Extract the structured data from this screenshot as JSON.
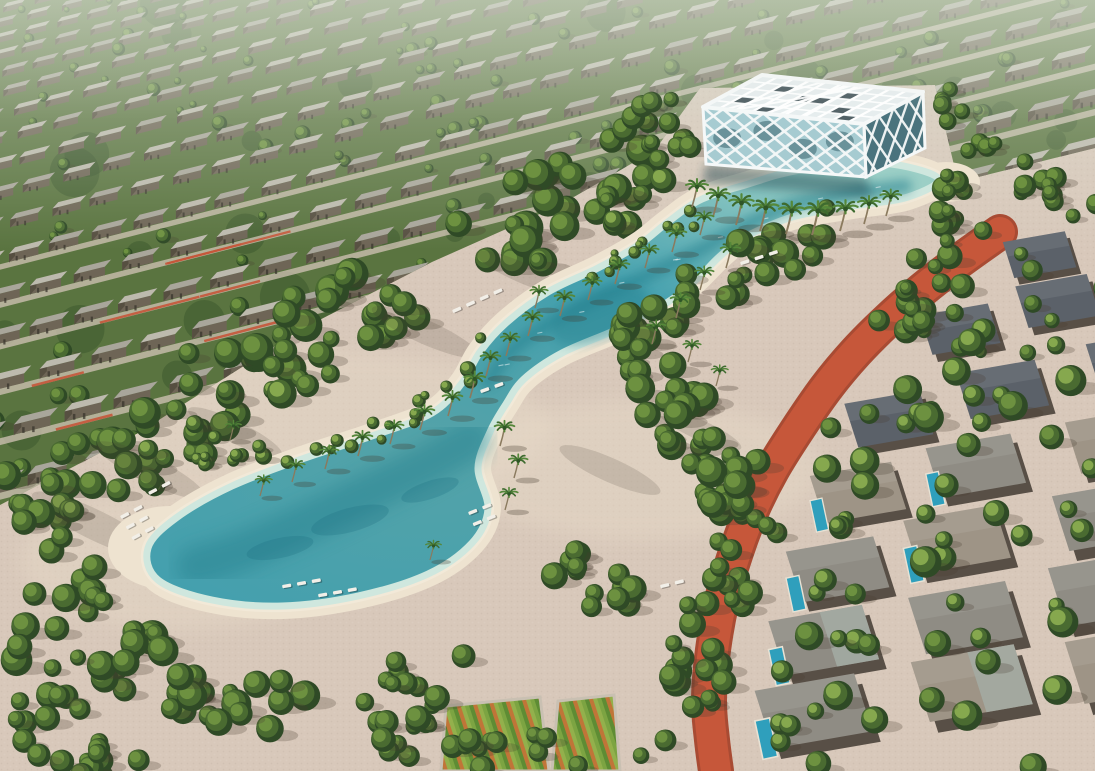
{
  "image": {
    "kind": "3d-aerial-render",
    "description": "Aerial render of a master-planned residential community: diagonal rows of grey-roofed townhouses among dense trees across the top, a white diagonal-lattice glass pavilion standing in a turquoise lagoon, a winding sandy-edged swim lagoon dotted with palm trees and white sun loungers, a terracotta jogging track curving along a district of flat-roofed pool villas on the right, and community garden plots with tree-lined cobbled plazas at the bottom.",
    "width": 1095,
    "height": 771
  },
  "palette": {
    "paving": "#d8c8ba",
    "pavingLight": "#e7dac8",
    "pavingWarm": "#dcc9b8",
    "sand": "#eee3d0",
    "sandBright": "#f4ebdb",
    "waterShallow": "#cfe7de",
    "waterLight": "#9ccfc6",
    "waterMid": "#55a3a8",
    "waterDeep": "#27818f",
    "waterChannel": "#44a0ae",
    "treeDark": "#2f4a26",
    "treeMid": "#4a6b31",
    "treeLight": "#6d9140",
    "treeBright": "#86a84e",
    "shrub": "#9ab04f",
    "roofLight": "#a9a69b",
    "roofPale": "#bdbaae",
    "wallDark": "#564f41",
    "wallMid": "#6e6556",
    "track": "#c6573a",
    "trackEdge": "#a84b33",
    "villaRoofA": "#8f8c84",
    "villaRoofB": "#9e9486",
    "villaRoofDark": "#5b6169",
    "villaWall": "#584f46",
    "villaPanel": "#a3aca3",
    "pool": "#2f9fbc",
    "pavilionFrame": "#f5f8f8",
    "pavilionGlass": "#a6cbd1",
    "pavilionGlassDark": "#4a737d",
    "skylight": "#36464c",
    "shadow": "#473d30",
    "trunk": "#8a7a5e",
    "gardenA": "#7ca442",
    "gardenB": "#5e8c34",
    "gardenC": "#c07538",
    "gardenD": "#93b04c",
    "haze": "#dfe5d8",
    "grassBase": "#5a7440",
    "streetPale": "#d3c5b7"
  },
  "areas": [
    {
      "name": "townhouse-district",
      "label": "Townhouse rows with street trees"
    },
    {
      "name": "lattice-pavilion",
      "label": "White lattice clubhouse pavilion on the lagoon"
    },
    {
      "name": "swim-lagoon",
      "label": "Winding turquoise swim lagoon"
    },
    {
      "name": "beach",
      "label": "Sandy lagoon beaches"
    },
    {
      "name": "palm-grove",
      "label": "Palm trees along the lagoon"
    },
    {
      "name": "sun-loungers",
      "label": "White sun loungers on the beach"
    },
    {
      "name": "jogging-track",
      "label": "Terracotta jogging track"
    },
    {
      "name": "villa-district",
      "label": "Flat-roof villas with private pools"
    },
    {
      "name": "community-gardens",
      "label": "Community garden allotments"
    },
    {
      "name": "plaza",
      "label": "Cobbled plaza with tree clusters"
    }
  ],
  "geometry": {
    "canvas": [
      1095,
      771
    ],
    "housing": {
      "clip": [
        [
          0,
          0
        ],
        [
          1095,
          0
        ],
        [
          1095,
          148
        ],
        [
          958,
          182
        ],
        [
          935,
          85
        ],
        [
          700,
          88
        ],
        [
          655,
          150
        ],
        [
          560,
          205
        ],
        [
          432,
          262
        ],
        [
          300,
          330
        ],
        [
          140,
          432
        ],
        [
          0,
          505
        ]
      ],
      "slope": 0.26,
      "rowStartY": 8,
      "rowMaxY": 520
    },
    "forest": {
      "path": [
        [
          0,
          505
        ],
        [
          140,
          435
        ],
        [
          300,
          332
        ],
        [
          432,
          265
        ],
        [
          560,
          208
        ],
        [
          650,
          152
        ]
      ],
      "width": 85,
      "count": 78
    },
    "lagoonOutline": [
      [
        938,
        178
      ],
      [
        880,
        163
      ],
      [
        800,
        170
      ],
      [
        745,
        185
      ],
      [
        700,
        200
      ],
      [
        668,
        222
      ],
      [
        640,
        244
      ],
      [
        598,
        268
      ],
      [
        548,
        292
      ],
      [
        506,
        323
      ],
      [
        480,
        352
      ],
      [
        462,
        383
      ],
      [
        432,
        413
      ],
      [
        372,
        436
      ],
      [
        302,
        459
      ],
      [
        232,
        486
      ],
      [
        176,
        518
      ],
      [
        148,
        548
      ],
      [
        158,
        580
      ],
      [
        212,
        600
      ],
      [
        282,
        606
      ],
      [
        358,
        596
      ],
      [
        428,
        574
      ],
      [
        472,
        543
      ],
      [
        488,
        509
      ],
      [
        478,
        468
      ],
      [
        490,
        432
      ],
      [
        506,
        404
      ],
      [
        524,
        379
      ],
      [
        562,
        353
      ],
      [
        620,
        328
      ],
      [
        668,
        302
      ],
      [
        696,
        280
      ],
      [
        718,
        258
      ],
      [
        740,
        240
      ],
      [
        768,
        226
      ],
      [
        800,
        215
      ],
      [
        852,
        206
      ],
      [
        908,
        197
      ]
    ],
    "channelCenter": [
      [
        905,
        186
      ],
      [
        848,
        194
      ],
      [
        792,
        205
      ],
      [
        744,
        226
      ],
      [
        700,
        250
      ],
      [
        650,
        274
      ],
      [
        600,
        298
      ],
      [
        552,
        322
      ],
      [
        512,
        350
      ],
      [
        488,
        382
      ]
    ],
    "teardropCenter": [
      [
        470,
        440
      ],
      [
        424,
        466
      ],
      [
        362,
        496
      ],
      [
        300,
        526
      ],
      [
        240,
        552
      ],
      [
        196,
        566
      ]
    ],
    "midPoolEllipse": [
      600,
      315,
      52,
      24,
      -23
    ],
    "track": {
      "path": [
        [
          1000,
          232
        ],
        [
          958,
          262
        ],
        [
          922,
          290
        ],
        [
          888,
          320
        ],
        [
          856,
          352
        ],
        [
          826,
          388
        ],
        [
          797,
          430
        ],
        [
          772,
          470
        ],
        [
          752,
          510
        ],
        [
          736,
          552
        ],
        [
          722,
          600
        ],
        [
          713,
          650
        ],
        [
          709,
          700
        ],
        [
          712,
          740
        ],
        [
          716,
          771
        ]
      ],
      "width": 30
    },
    "bands": [
      {
        "path": [
          [
            608,
            348
          ],
          [
            666,
            312
          ],
          [
            728,
            276
          ],
          [
            790,
            246
          ],
          [
            846,
            226
          ]
        ],
        "width": 55,
        "count": 32,
        "r": [
          8,
          15
        ]
      },
      {
        "path": [
          [
            612,
            352
          ],
          [
            668,
            402
          ],
          [
            718,
            458
          ],
          [
            752,
            516
          ]
        ],
        "width": 65,
        "count": 34,
        "r": [
          9,
          16
        ]
      },
      {
        "path": [
          [
            768,
            480
          ],
          [
            736,
            556
          ],
          [
            706,
            642
          ],
          [
            678,
            724
          ],
          [
            664,
            771
          ]
        ],
        "width": 60,
        "count": 32,
        "r": [
          8,
          15
        ]
      },
      {
        "path": [
          [
            0,
            622
          ],
          [
            96,
            652
          ],
          [
            200,
            682
          ],
          [
            310,
            700
          ]
        ],
        "width": 75,
        "count": 40,
        "r": [
          8,
          16
        ]
      },
      {
        "path": [
          [
            360,
            716
          ],
          [
            440,
            736
          ],
          [
            520,
            758
          ],
          [
            580,
            771
          ]
        ],
        "width": 55,
        "count": 24,
        "r": [
          7,
          13
        ]
      },
      {
        "path": [
          [
            940,
            180
          ],
          [
            966,
            214
          ],
          [
            952,
            258
          ],
          [
            920,
            295
          ],
          [
            888,
            330
          ]
        ],
        "width": 55,
        "count": 28,
        "r": [
          7,
          13
        ]
      },
      {
        "path": [
          [
            648,
            100
          ],
          [
            662,
            128
          ],
          [
            680,
            155
          ]
        ],
        "width": 42,
        "count": 12,
        "r": [
          7,
          12
        ]
      },
      {
        "path": [
          [
            196,
            452
          ],
          [
            240,
            448
          ],
          [
            266,
            458
          ]
        ],
        "width": 28,
        "count": 10,
        "r": [
          5,
          9
        ],
        "bright": true
      },
      {
        "path": [
          [
            560,
            560
          ],
          [
            600,
            586
          ],
          [
            636,
            614
          ]
        ],
        "width": 48,
        "count": 16,
        "r": [
          8,
          14
        ]
      },
      {
        "path": [
          [
            30,
            498
          ],
          [
            66,
            556
          ],
          [
            94,
            612
          ]
        ],
        "width": 44,
        "count": 12,
        "r": [
          8,
          15
        ]
      },
      {
        "path": [
          [
            506,
            323
          ],
          [
            462,
            383
          ],
          [
            372,
            436
          ],
          [
            302,
            459
          ],
          [
            232,
            486
          ]
        ],
        "width": 24,
        "count": 18,
        "r": [
          4,
          8
        ],
        "bright": true,
        "noShadow": true
      },
      {
        "path": [
          [
            700,
            215
          ],
          [
            652,
            243
          ],
          [
            598,
            268
          ],
          [
            548,
            292
          ]
        ],
        "width": 18,
        "count": 12,
        "r": [
          4,
          7
        ],
        "bright": true,
        "noShadow": true
      },
      {
        "path": [
          [
            928,
            95
          ],
          [
            962,
            125
          ],
          [
            996,
            150
          ]
        ],
        "width": 38,
        "count": 10,
        "r": [
          7,
          11
        ]
      },
      {
        "path": [
          [
            1005,
            170
          ],
          [
            1050,
            195
          ],
          [
            1088,
            225
          ]
        ],
        "width": 44,
        "count": 12,
        "r": [
          7,
          12
        ]
      },
      {
        "path": [
          [
            0,
            700
          ],
          [
            60,
            730
          ],
          [
            140,
            760
          ]
        ],
        "width": 70,
        "count": 20,
        "r": [
          8,
          15
        ]
      },
      {
        "path": [
          [
            356,
            700
          ],
          [
            420,
            660
          ],
          [
            470,
            690
          ]
        ],
        "width": 60,
        "count": 8,
        "r": [
          8,
          13
        ]
      }
    ],
    "streaks": [
      [
        150,
        470,
        60,
        13,
        26
      ],
      [
        95,
        525,
        70,
        15,
        26
      ],
      [
        235,
        432,
        52,
        11,
        26
      ],
      [
        425,
        332,
        58,
        12,
        24
      ],
      [
        520,
        272,
        48,
        10,
        24
      ],
      [
        610,
        470,
        55,
        12,
        24
      ],
      [
        700,
        430,
        45,
        10,
        24
      ]
    ],
    "toneSpots": [
      [
        320,
        430,
        230,
        80
      ],
      [
        640,
        470,
        180,
        70
      ],
      [
        180,
        560,
        160,
        70
      ]
    ],
    "gardens": [
      [
        [
          446,
          706
        ],
        [
          540,
          697
        ],
        [
          549,
          771
        ],
        [
          441,
          771
        ]
      ],
      [
        [
          558,
          701
        ],
        [
          614,
          695
        ],
        [
          620,
          771
        ],
        [
          552,
          771
        ]
      ]
    ],
    "palms": [
      [
        692,
        207,
        1.0
      ],
      [
        713,
        217,
        1.05
      ],
      [
        736,
        225,
        1.1
      ],
      [
        760,
        231,
        1.15
      ],
      [
        786,
        234,
        1.15
      ],
      [
        812,
        235,
        1.2
      ],
      [
        840,
        231,
        1.1
      ],
      [
        864,
        224,
        1.0
      ],
      [
        886,
        216,
        0.95
      ],
      [
        700,
        235,
        0.85
      ],
      [
        672,
        252,
        0.9
      ],
      [
        645,
        268,
        0.85
      ],
      [
        615,
        284,
        0.9
      ],
      [
        588,
        300,
        0.85
      ],
      [
        560,
        316,
        0.9
      ],
      [
        535,
        308,
        0.8
      ],
      [
        726,
        268,
        0.9
      ],
      [
        700,
        290,
        0.85
      ],
      [
        676,
        318,
        0.9
      ],
      [
        652,
        344,
        0.85
      ],
      [
        688,
        362,
        0.8
      ],
      [
        716,
        386,
        0.75
      ],
      [
        528,
        336,
        0.9
      ],
      [
        506,
        356,
        0.85
      ],
      [
        486,
        376,
        0.9
      ],
      [
        470,
        398,
        0.95
      ],
      [
        448,
        416,
        0.9
      ],
      [
        420,
        430,
        0.9
      ],
      [
        390,
        444,
        0.85
      ],
      [
        358,
        456,
        0.9
      ],
      [
        325,
        469,
        0.85
      ],
      [
        292,
        482,
        0.8
      ],
      [
        260,
        496,
        0.75
      ],
      [
        500,
        446,
        0.9
      ],
      [
        514,
        478,
        0.85
      ],
      [
        505,
        510,
        0.8
      ],
      [
        430,
        560,
        0.7
      ],
      [
        230,
        440,
        0.7
      ]
    ],
    "loungerClusters": [
      [
        120,
        516,
        -28,
        3,
        2
      ],
      [
        148,
        492,
        -28,
        1,
        2
      ],
      [
        282,
        585,
        -10,
        1,
        3
      ],
      [
        318,
        594,
        -10,
        1,
        3
      ],
      [
        468,
        512,
        -22,
        2,
        2
      ],
      [
        452,
        310,
        -24,
        1,
        4
      ],
      [
        740,
        262,
        -18,
        1,
        3
      ],
      [
        660,
        585,
        -14,
        1,
        2
      ],
      [
        480,
        390,
        -20,
        1,
        2
      ]
    ],
    "pavilion": {
      "L": [
        703,
        107
      ],
      "B": [
        762,
        75
      ],
      "R": [
        923,
        92
      ],
      "F": [
        864,
        124
      ],
      "heights": [
        57,
        53,
        56
      ],
      "skylights": [
        [
          1,
          1
        ],
        [
          3,
          0
        ],
        [
          5,
          2
        ],
        [
          7,
          1
        ],
        [
          2,
          3
        ],
        [
          6,
          3
        ],
        [
          8,
          0
        ],
        [
          4,
          2
        ]
      ]
    },
    "villas": {
      "rows": 7,
      "y0": 252,
      "dy": 76,
      "cols": 3,
      "treeCount": 55
    }
  }
}
